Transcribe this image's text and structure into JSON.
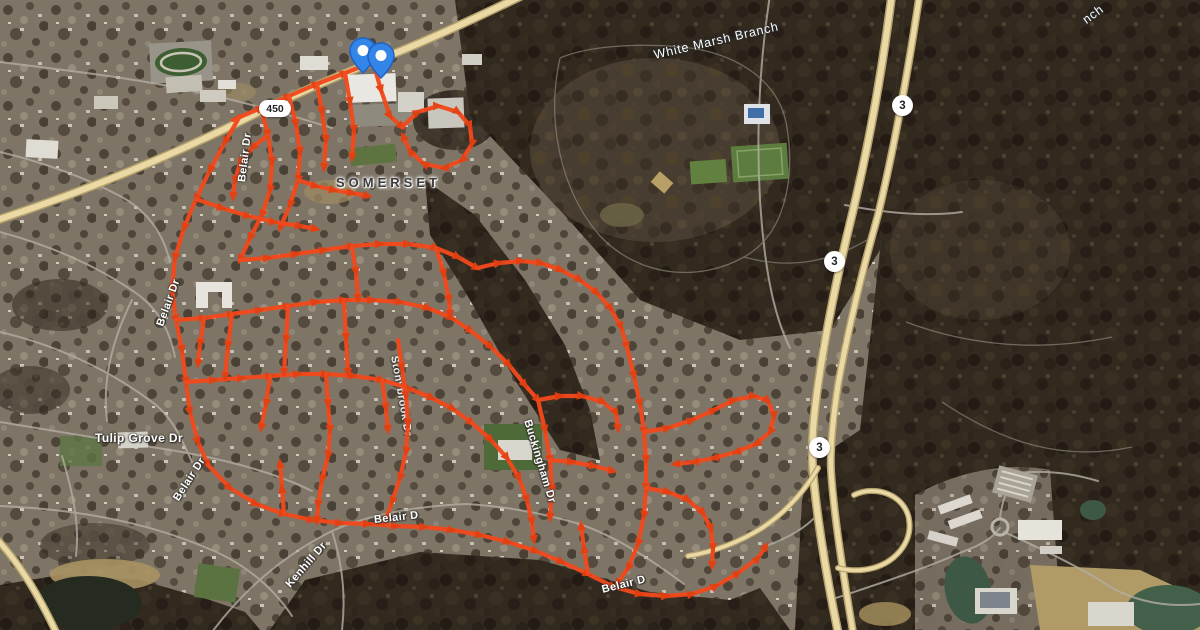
{
  "map": {
    "neighborhood_label": "SOMERSET",
    "water_labels": {
      "main": "White Marsh Branch",
      "partial_top_right": "nch"
    },
    "road_labels": {
      "tulip_grove_dr": "Tulip Grove Dr",
      "kenhill_dr": "Kenhill Dr",
      "belair_dr_upper": "Belair Dr",
      "belair_dr_mid": "Belair Dr",
      "belair_dr_lower": "Belair Dr",
      "belair_dr_south": "Belair D",
      "belair_dr_southeast": "Belair D",
      "buckingham_dr": "Buckingham Dr",
      "stonybrook_dr": "Stonybrook Dr"
    },
    "shields": {
      "route_450": "450",
      "route_3": "3"
    },
    "overlay": {
      "route_color": "#f2491c",
      "arrow_color": "#e63f10",
      "description": "GPS street-running route with direction arrows"
    },
    "pins": {
      "count": 2,
      "color": "#3385e8"
    }
  }
}
